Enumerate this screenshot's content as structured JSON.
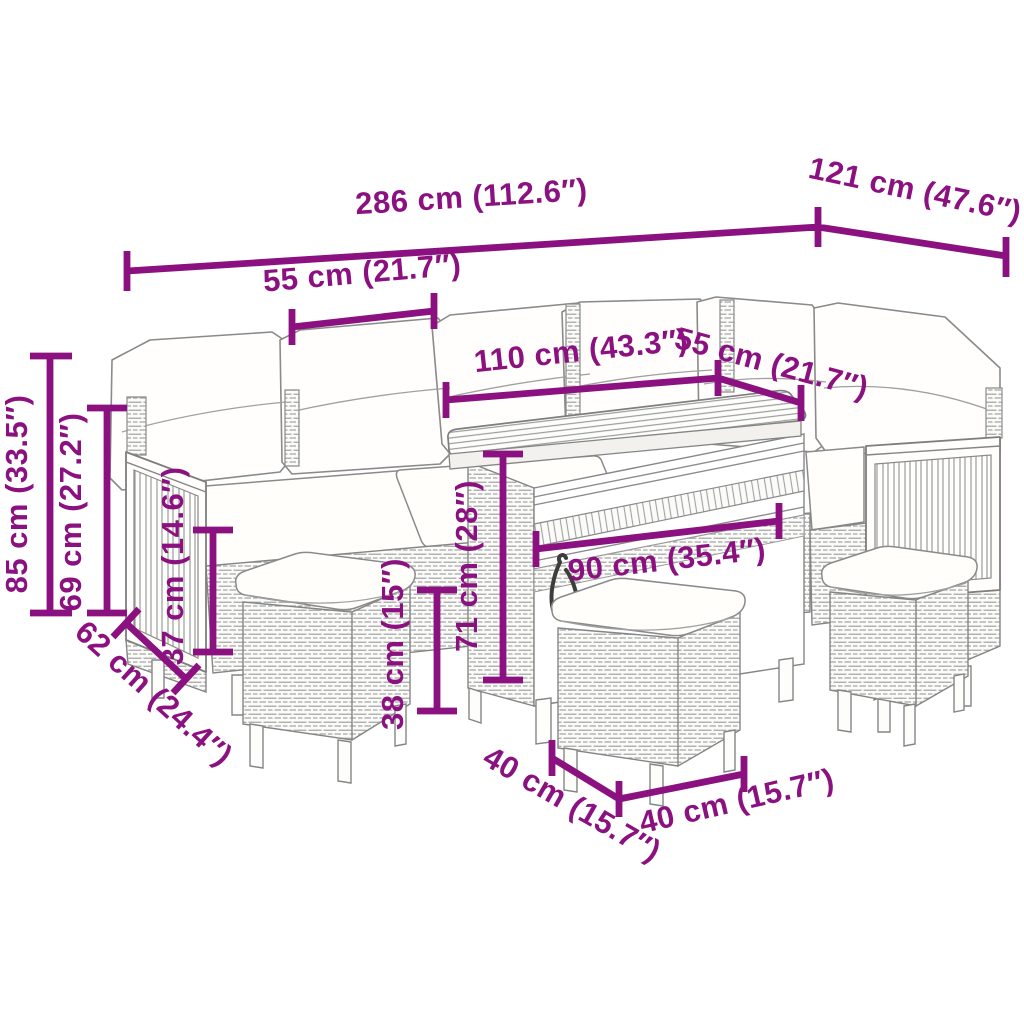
{
  "figure": {
    "type": "product-dimension-diagram",
    "subject": "poly rattan garden lounge set with cushions, dining table and three stools",
    "accent_color": "#8C1180",
    "line_art_color": "#858585",
    "background_color": "#ffffff"
  },
  "dimensions": {
    "total_width": "286 cm (112.6″)",
    "side_section_depth": "121 cm (47.6″)",
    "left_seat_width": "55 cm (21.7″)",
    "table_length": "110 cm (43.3″)",
    "right_seat_width": "55 cm (21.7″)",
    "back_height": "85 cm (33.5″)",
    "armrest_height": "69 cm (27.2″)",
    "seat_height": "37 cm (14.6″)",
    "seat_depth": "62 cm (24.4″)",
    "table_height": "71 cm (28″)",
    "stool_height": "38 cm (15″)",
    "table_width": "90 cm (35.4″)",
    "stool_width": "40 cm (15.7″)",
    "stool_depth": "40 cm (15.7″)"
  }
}
